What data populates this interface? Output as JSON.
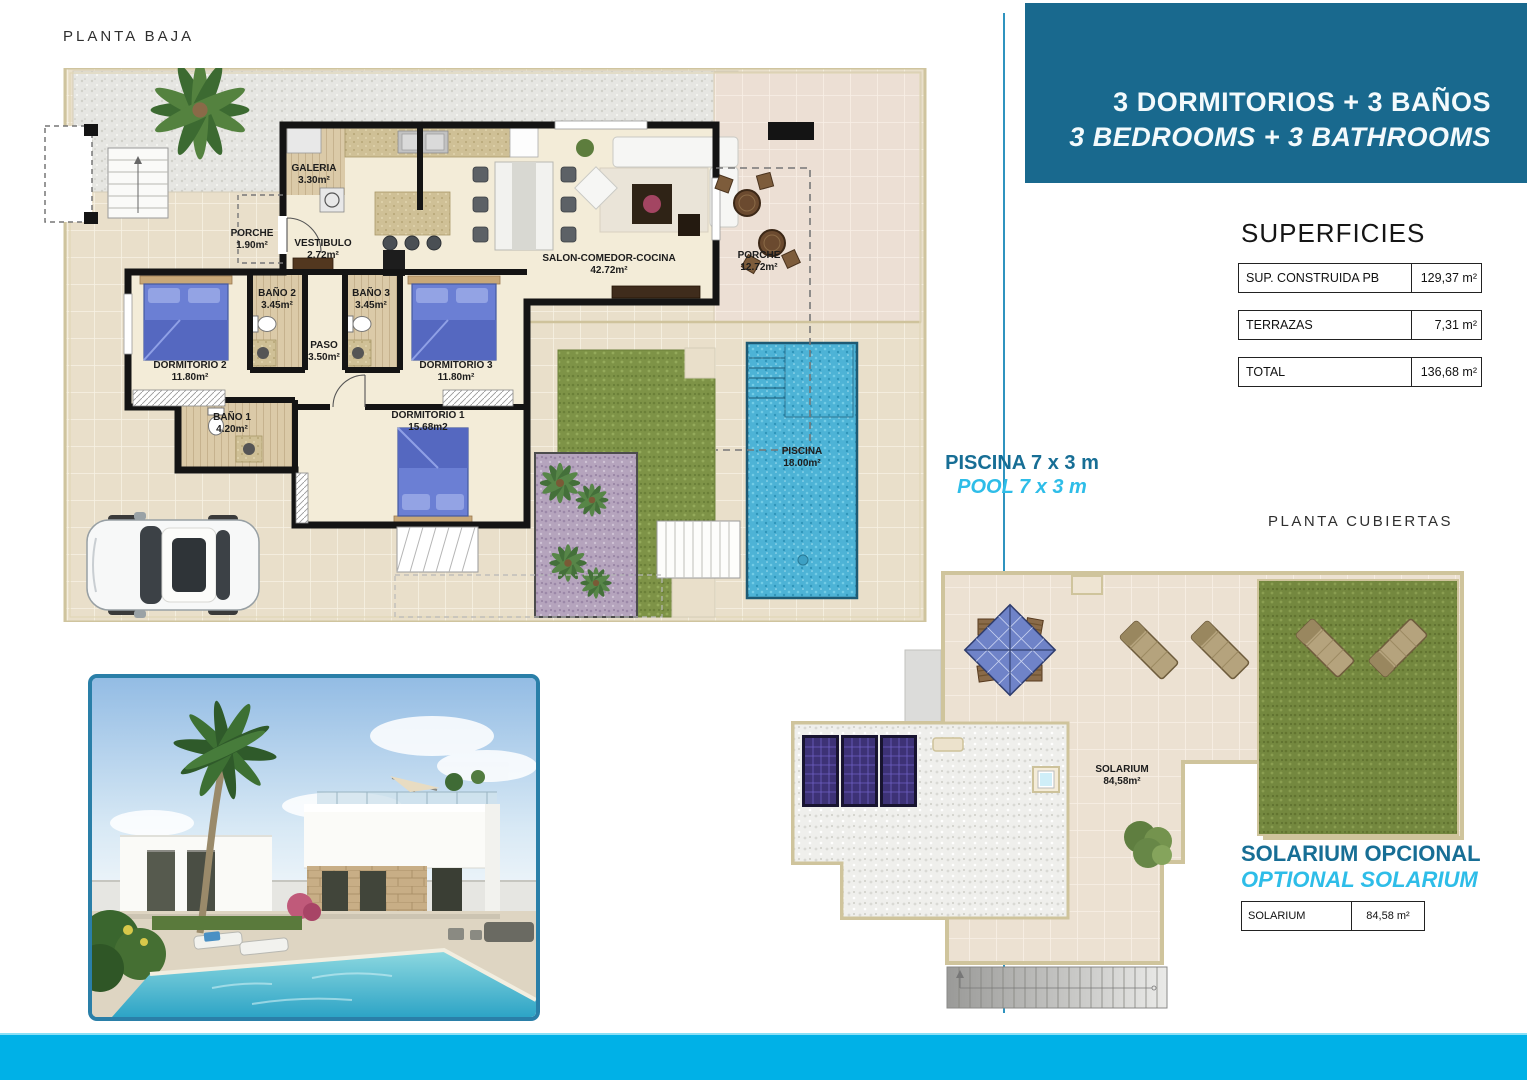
{
  "titles": {
    "ground": "PLANTA BAJA",
    "roof": "PLANTA CUBIERTAS"
  },
  "banner": {
    "line1": "3 DORMITORIOS + 3 BAÑOS",
    "line2": "3 BEDROOMS + 3 BATHROOMS"
  },
  "superficies": {
    "title": "SUPERFICIES",
    "rows": [
      {
        "label": "SUP. CONSTRUIDA PB",
        "value": "129,37 m²"
      },
      {
        "label": "TERRAZAS",
        "value": "7,31 m²"
      },
      {
        "label": "TOTAL",
        "value": "136,68 m²"
      }
    ]
  },
  "pool_note": {
    "es": "PISCINA 7 x 3 m",
    "en": "POOL 7 x 3 m"
  },
  "solarium_note": {
    "es": "SOLARIUM OPCIONAL",
    "en": "OPTIONAL SOLARIUM",
    "row": {
      "label": "SOLARIUM",
      "value": "84,58 m²"
    }
  },
  "ground_floor": {
    "labels": [
      {
        "name": "GALERIA",
        "area": "3.30m²",
        "x": 274,
        "y": 95
      },
      {
        "name": "PORCHE",
        "area": "1.90m²",
        "x": 212,
        "y": 160
      },
      {
        "name": "VESTIBULO",
        "area": "2.72m²",
        "x": 283,
        "y": 170
      },
      {
        "name": "SALON-COMEDOR-COCINA",
        "area": "42.72m²",
        "x": 569,
        "y": 185
      },
      {
        "name": "PORCHE",
        "area": "12.72m²",
        "x": 719,
        "y": 182
      },
      {
        "name": "BAÑO 2",
        "area": "3.45m²",
        "x": 237,
        "y": 220
      },
      {
        "name": "BAÑO 3",
        "area": "3.45m²",
        "x": 331,
        "y": 220
      },
      {
        "name": "PASO",
        "area": "3.50m²",
        "x": 284,
        "y": 272
      },
      {
        "name": "DORMITORIO 2",
        "area": "11.80m²",
        "x": 150,
        "y": 292
      },
      {
        "name": "DORMITORIO 3",
        "area": "11.80m²",
        "x": 416,
        "y": 292
      },
      {
        "name": "BAÑO 1",
        "area": "4.20m²",
        "x": 192,
        "y": 344
      },
      {
        "name": "DORMITORIO 1",
        "area": "15.68m2",
        "x": 388,
        "y": 342
      },
      {
        "name": "PISCINA",
        "area": "18.00m²",
        "x": 762,
        "y": 378
      }
    ]
  },
  "roof": {
    "labels": [
      {
        "name": "SOLARIUM",
        "area": "84,58m²",
        "x": 342,
        "y": 204
      }
    ]
  },
  "colors": {
    "banner_bg": "#19698e",
    "accent_dark": "#176e95",
    "accent_cyan": "#2ebde8",
    "bottom_bar": "#00b1e7",
    "divider": "#2f93bf",
    "photo_border": "#2a7fa8"
  }
}
